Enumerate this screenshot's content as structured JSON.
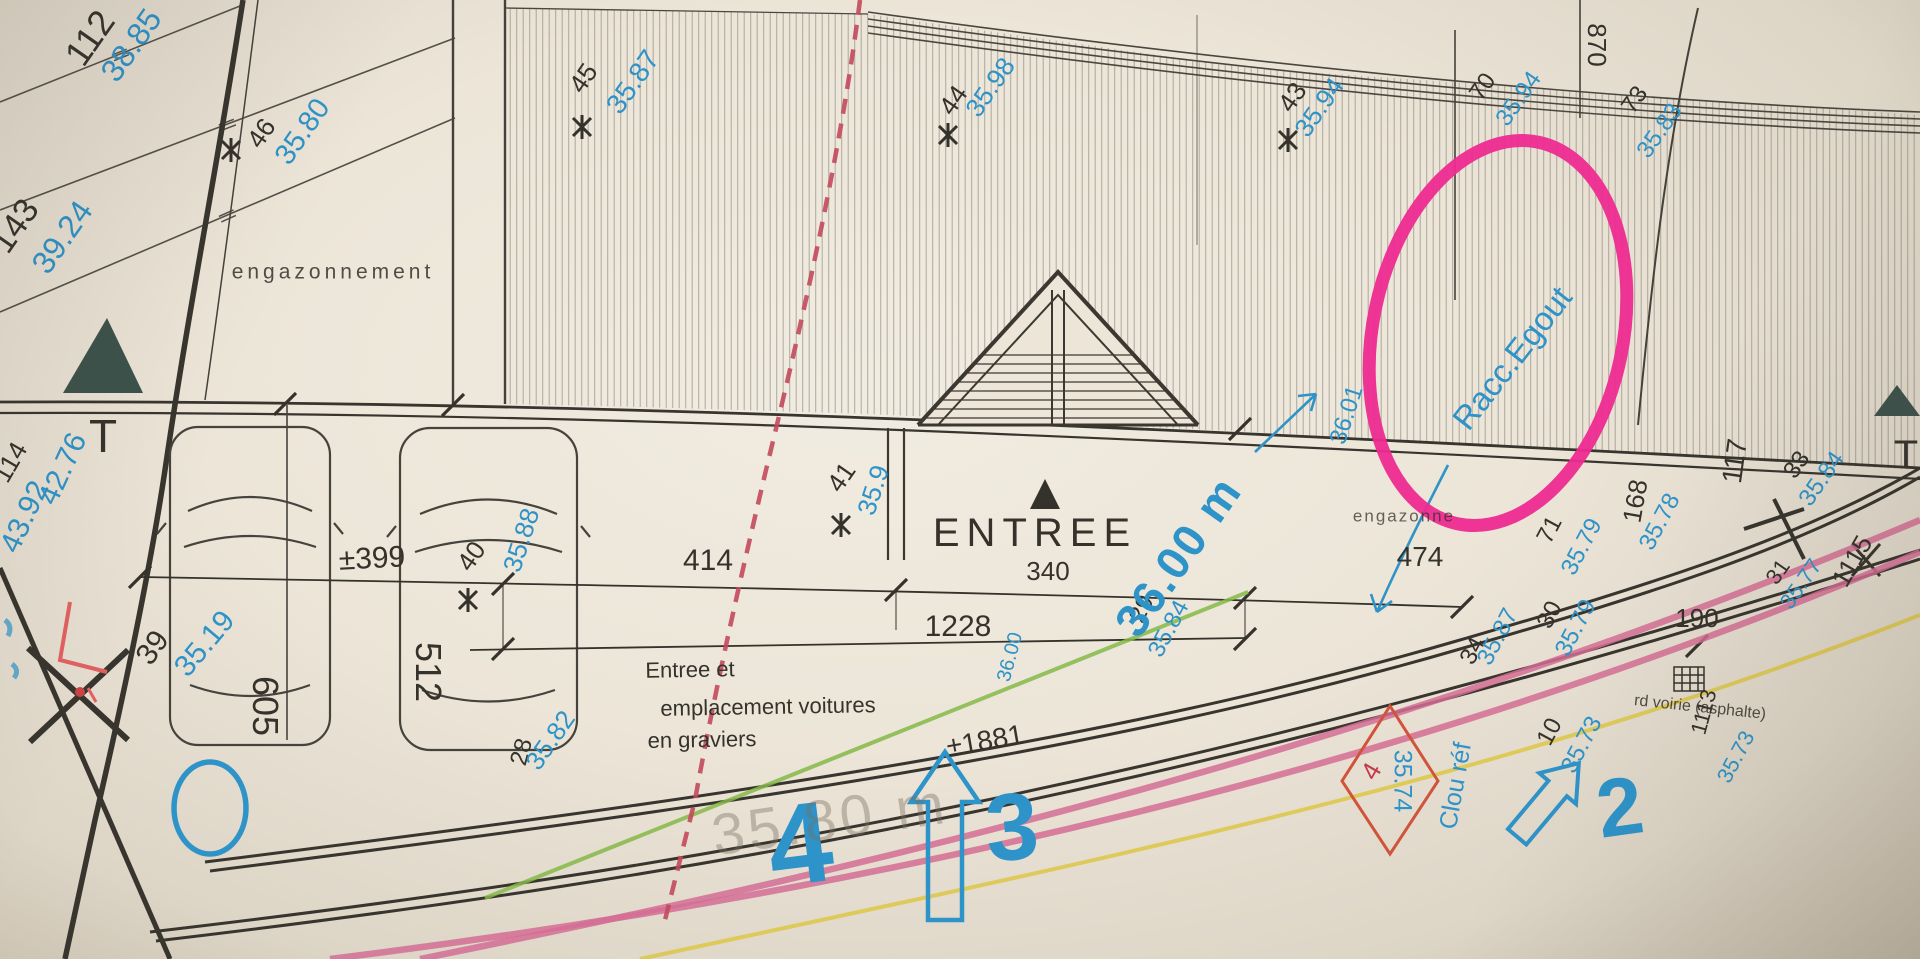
{
  "colors": {
    "ink": "#35322c",
    "blue": "#2e93c8",
    "marker_pink": "#ee2a90",
    "red": "#c6394a",
    "diamond_red": "#d0543c",
    "green": "#84b946",
    "yellow": "#ddc84e",
    "road_pink": "#d46d94",
    "ghost": "rgba(120,110,95,0.40)",
    "triangle": "#3d524c"
  },
  "labels": [
    {
      "name": "survey-point-112",
      "text": "112",
      "x": 90,
      "y": 38,
      "rot": -55,
      "size": 36,
      "color": "ink"
    },
    {
      "name": "elevation-112",
      "text": "38.85",
      "x": 131,
      "y": 45,
      "rot": -55,
      "size": 32,
      "color": "blue"
    },
    {
      "name": "survey-point-143",
      "text": "143",
      "x": 15,
      "y": 226,
      "rot": -55,
      "size": 34,
      "color": "ink"
    },
    {
      "name": "elevation-143",
      "text": "39.24",
      "x": 62,
      "y": 237,
      "rot": -55,
      "size": 32,
      "color": "blue"
    },
    {
      "name": "survey-point-46",
      "text": "46",
      "x": 261,
      "y": 133,
      "rot": -55,
      "size": 26,
      "color": "ink"
    },
    {
      "name": "elevation-46",
      "text": "35.80",
      "x": 303,
      "y": 132,
      "rot": -55,
      "size": 29,
      "color": "blue"
    },
    {
      "name": "survey-point-45",
      "text": "45",
      "x": 583,
      "y": 78,
      "rot": -55,
      "size": 26,
      "color": "ink"
    },
    {
      "name": "elevation-45",
      "text": "35.87",
      "x": 633,
      "y": 82,
      "rot": -55,
      "size": 28,
      "color": "blue"
    },
    {
      "name": "survey-point-44",
      "text": "44",
      "x": 953,
      "y": 100,
      "rot": -55,
      "size": 26,
      "color": "ink"
    },
    {
      "name": "elevation-44",
      "text": "35.98",
      "x": 990,
      "y": 87,
      "rot": -55,
      "size": 26,
      "color": "blue"
    },
    {
      "name": "survey-point-43",
      "text": "43",
      "x": 1292,
      "y": 97,
      "rot": -55,
      "size": 26,
      "color": "ink"
    },
    {
      "name": "elevation-43",
      "text": "35.94",
      "x": 1319,
      "y": 107,
      "rot": -55,
      "size": 26,
      "color": "blue"
    },
    {
      "name": "survey-point-70",
      "text": "70",
      "x": 1483,
      "y": 87,
      "rot": -55,
      "size": 24,
      "color": "ink"
    },
    {
      "name": "elevation-70",
      "text": "35.94",
      "x": 1519,
      "y": 99,
      "rot": -55,
      "size": 24,
      "color": "blue"
    },
    {
      "name": "distance-870",
      "text": "870",
      "x": 1597,
      "y": 45,
      "rot": 90,
      "size": 26,
      "color": "ink"
    },
    {
      "name": "survey-point-73",
      "text": "73",
      "x": 1635,
      "y": 100,
      "rot": -55,
      "size": 24,
      "color": "ink"
    },
    {
      "name": "elevation-73",
      "text": "35.83",
      "x": 1660,
      "y": 131,
      "rot": -55,
      "size": 24,
      "color": "blue"
    },
    {
      "name": "survey-point-114",
      "text": "114",
      "x": 10,
      "y": 462,
      "rot": -60,
      "size": 26,
      "color": "ink"
    },
    {
      "name": "elevation-4392",
      "text": "43.92",
      "x": 25,
      "y": 517,
      "rot": -65,
      "size": 30,
      "color": "blue"
    },
    {
      "name": "elevation-4276",
      "text": "42.76",
      "x": 63,
      "y": 469,
      "rot": -65,
      "size": 30,
      "color": "blue"
    },
    {
      "name": "letter-T-left",
      "text": "T",
      "x": 103,
      "y": 436,
      "rot": 0,
      "size": 46,
      "color": "ink"
    },
    {
      "name": "letter-T-right",
      "text": "T",
      "x": 1906,
      "y": 455,
      "rot": 0,
      "size": 40,
      "color": "ink"
    },
    {
      "name": "area-engazonnement",
      "text": "engazonnement",
      "x": 333,
      "y": 272,
      "rot": 0,
      "size": 21,
      "color": "ink",
      "ls": 4,
      "opacity": 0.85
    },
    {
      "name": "area-engazonnement-right",
      "text": "engazonne",
      "x": 1404,
      "y": 516,
      "rot": 0,
      "size": 17,
      "color": "ink",
      "ls": 2,
      "opacity": 0.75
    },
    {
      "name": "parking-605",
      "text": "605",
      "x": 265,
      "y": 706,
      "rot": 90,
      "size": 36,
      "color": "ink"
    },
    {
      "name": "parking-512",
      "text": "512",
      "x": 428,
      "y": 672,
      "rot": 90,
      "size": 36,
      "color": "ink"
    },
    {
      "name": "dim-399",
      "text": "±399",
      "x": 372,
      "y": 559,
      "rot": -3,
      "size": 30,
      "color": "ink"
    },
    {
      "name": "dim-414",
      "text": "414",
      "x": 708,
      "y": 561,
      "rot": 0,
      "size": 30,
      "color": "ink"
    },
    {
      "name": "dim-1228",
      "text": "1228",
      "x": 958,
      "y": 627,
      "rot": 0,
      "size": 30,
      "color": "ink"
    },
    {
      "name": "dim-474",
      "text": "474",
      "x": 1420,
      "y": 557,
      "rot": 0,
      "size": 28,
      "color": "ink"
    },
    {
      "name": "dim-1881",
      "text": "±1881",
      "x": 985,
      "y": 741,
      "rot": -10,
      "size": 28,
      "color": "ink"
    },
    {
      "name": "label-entree",
      "text": "ENTREE",
      "x": 1035,
      "y": 533,
      "rot": 0,
      "size": 40,
      "color": "ink",
      "ls": 7
    },
    {
      "name": "dim-340",
      "text": "340",
      "x": 1048,
      "y": 571,
      "rot": 0,
      "size": 26,
      "color": "ink"
    },
    {
      "name": "survey-point-39",
      "text": "39",
      "x": 153,
      "y": 648,
      "rot": -55,
      "size": 30,
      "color": "ink"
    },
    {
      "name": "elevation-39",
      "text": "35.19",
      "x": 205,
      "y": 644,
      "rot": -50,
      "size": 30,
      "color": "blue"
    },
    {
      "name": "survey-point-40",
      "text": "40",
      "x": 471,
      "y": 556,
      "rot": -55,
      "size": 26,
      "color": "ink"
    },
    {
      "name": "elevation-40",
      "text": "35.88",
      "x": 521,
      "y": 540,
      "rot": -72,
      "size": 26,
      "color": "blue"
    },
    {
      "name": "survey-point-41",
      "text": "41",
      "x": 841,
      "y": 477,
      "rot": -55,
      "size": 26,
      "color": "ink"
    },
    {
      "name": "elevation-41",
      "text": "35.9",
      "x": 873,
      "y": 490,
      "rot": -72,
      "size": 26,
      "color": "blue"
    },
    {
      "name": "survey-point-28",
      "text": "28",
      "x": 522,
      "y": 752,
      "rot": -75,
      "size": 24,
      "color": "ink"
    },
    {
      "name": "elevation-28",
      "text": "35.82",
      "x": 550,
      "y": 740,
      "rot": -55,
      "size": 26,
      "color": "blue"
    },
    {
      "name": "survey-point-29",
      "text": "29",
      "x": 1142,
      "y": 609,
      "rot": -62,
      "size": 24,
      "color": "ink"
    },
    {
      "name": "elevation-29",
      "text": "35.84",
      "x": 1169,
      "y": 629,
      "rot": -62,
      "size": 24,
      "color": "blue"
    },
    {
      "name": "survey-point-34",
      "text": "34",
      "x": 1473,
      "y": 651,
      "rot": -62,
      "size": 24,
      "color": "ink"
    },
    {
      "name": "elevation-34",
      "text": "35.87",
      "x": 1498,
      "y": 637,
      "rot": -62,
      "size": 24,
      "color": "blue"
    },
    {
      "name": "survey-point-30",
      "text": "30",
      "x": 1550,
      "y": 615,
      "rot": -62,
      "size": 24,
      "color": "ink"
    },
    {
      "name": "elevation-30",
      "text": "35.79",
      "x": 1576,
      "y": 628,
      "rot": -62,
      "size": 24,
      "color": "blue"
    },
    {
      "name": "survey-point-10",
      "text": "10",
      "x": 1550,
      "y": 732,
      "rot": -62,
      "size": 24,
      "color": "ink"
    },
    {
      "name": "elevation-10",
      "text": "35.73",
      "x": 1582,
      "y": 745,
      "rot": -62,
      "size": 24,
      "color": "blue"
    },
    {
      "name": "survey-point-71",
      "text": "71",
      "x": 1550,
      "y": 530,
      "rot": -62,
      "size": 24,
      "color": "ink"
    },
    {
      "name": "elevation-71",
      "text": "35.79",
      "x": 1582,
      "y": 547,
      "rot": -62,
      "size": 24,
      "color": "blue"
    },
    {
      "name": "dim-168",
      "text": "168",
      "x": 1635,
      "y": 501,
      "rot": -80,
      "size": 26,
      "color": "ink"
    },
    {
      "name": "elevation-168",
      "text": "35.78",
      "x": 1660,
      "y": 522,
      "rot": -62,
      "size": 24,
      "color": "blue"
    },
    {
      "name": "dim-117",
      "text": "117",
      "x": 1735,
      "y": 461,
      "rot": -82,
      "size": 28,
      "color": "ink"
    },
    {
      "name": "survey-point-33",
      "text": "33",
      "x": 1797,
      "y": 465,
      "rot": -55,
      "size": 24,
      "color": "ink"
    },
    {
      "name": "elevation-33",
      "text": "35.84",
      "x": 1822,
      "y": 479,
      "rot": -55,
      "size": 24,
      "color": "blue"
    },
    {
      "name": "survey-point-31",
      "text": "31",
      "x": 1778,
      "y": 572,
      "rot": -55,
      "size": 22,
      "color": "ink"
    },
    {
      "name": "elevation-31",
      "text": "35.77",
      "x": 1801,
      "y": 584,
      "rot": -55,
      "size": 22,
      "color": "blue"
    },
    {
      "name": "dim-1115",
      "text": "1115",
      "x": 1852,
      "y": 561,
      "rot": -60,
      "size": 26,
      "color": "ink"
    },
    {
      "name": "dim-190",
      "text": "190",
      "x": 1697,
      "y": 618,
      "rot": 0,
      "size": 26,
      "color": "ink"
    },
    {
      "name": "dim-1113",
      "text": "1113",
      "x": 1704,
      "y": 712,
      "rot": -75,
      "size": 22,
      "color": "ink"
    },
    {
      "name": "elevation-road",
      "text": "35.73",
      "x": 1736,
      "y": 757,
      "rot": -62,
      "size": 22,
      "color": "blue"
    },
    {
      "name": "note-graviers-line1",
      "text": "Entree et",
      "x": 690,
      "y": 670,
      "rot": -1,
      "size": 22,
      "color": "ink"
    },
    {
      "name": "note-graviers-line2",
      "text": "emplacement voitures",
      "x": 768,
      "y": 707,
      "rot": -1,
      "size": 22,
      "color": "ink"
    },
    {
      "name": "note-graviers-line3",
      "text": "en graviers",
      "x": 702,
      "y": 740,
      "rot": -1,
      "size": 22,
      "color": "ink"
    },
    {
      "name": "note-racc-egout",
      "text": "Racc.Egout",
      "x": 1512,
      "y": 358,
      "rot": -52,
      "size": 33,
      "color": "blue"
    },
    {
      "name": "note-36-00-m",
      "text": "36.00 m",
      "x": 1178,
      "y": 556,
      "rot": -55,
      "size": 46,
      "color": "blue",
      "weight": "bold",
      "ls": 2
    },
    {
      "name": "elevation-3601",
      "text": "36.01",
      "x": 1347,
      "y": 415,
      "rot": -72,
      "size": 24,
      "color": "blue"
    },
    {
      "name": "dim-3600-small",
      "text": "36.00",
      "x": 1010,
      "y": 657,
      "rot": -75,
      "size": 20,
      "color": "blue"
    },
    {
      "name": "handwriting-4",
      "text": "4",
      "x": 800,
      "y": 845,
      "rot": -7,
      "size": 115,
      "color": "blue",
      "weight": "bold"
    },
    {
      "name": "handwriting-3",
      "text": "3",
      "x": 1012,
      "y": 828,
      "rot": -4,
      "size": 95,
      "color": "blue",
      "weight": "bold"
    },
    {
      "name": "handwriting-2",
      "text": "2",
      "x": 1620,
      "y": 808,
      "rot": -8,
      "size": 82,
      "color": "blue",
      "weight": "bold"
    },
    {
      "name": "note-clou-ref",
      "text": "Clou réf",
      "x": 1456,
      "y": 786,
      "rot": -80,
      "size": 25,
      "color": "blue"
    },
    {
      "name": "elevation-clou",
      "text": "35.74",
      "x": 1402,
      "y": 781,
      "rot": 90,
      "size": 25,
      "color": "blue"
    },
    {
      "name": "point-clou-4",
      "text": "4",
      "x": 1371,
      "y": 771,
      "rot": -60,
      "size": 26,
      "color": "red"
    },
    {
      "name": "note-voirie",
      "text": "rd voirie (asphalte)",
      "x": 1700,
      "y": 708,
      "rot": 6,
      "size": 16,
      "color": "ink",
      "opacity": 0.85
    },
    {
      "name": "ghost-3580",
      "text": "35.80 m",
      "x": 830,
      "y": 820,
      "rot": -8,
      "size": 58,
      "color": "ghost",
      "ls": 4
    }
  ]
}
